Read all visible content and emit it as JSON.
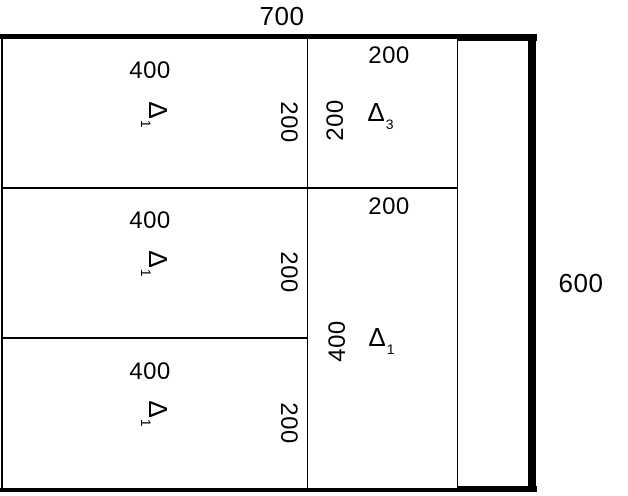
{
  "drawing": {
    "type": "structural-floor-plan",
    "overall_width_label": "700",
    "overall_height_label": "600",
    "colors": {
      "line": "#000000",
      "background": "#ffffff"
    },
    "left_rooms": [
      {
        "width_label": "400",
        "height_label": "200",
        "marker": "Δ",
        "marker_sub": "1"
      },
      {
        "width_label": "400",
        "height_label": "200",
        "marker": "Δ",
        "marker_sub": "1"
      },
      {
        "width_label": "400",
        "height_label": "200",
        "marker": "Δ",
        "marker_sub": "1"
      }
    ],
    "middle_rooms": [
      {
        "width_label": "200",
        "height_label": "200",
        "marker": "Δ",
        "marker_sub": "3"
      },
      {
        "width_label": "200",
        "height_label": "400",
        "marker": "Δ",
        "marker_sub": "1"
      }
    ]
  }
}
